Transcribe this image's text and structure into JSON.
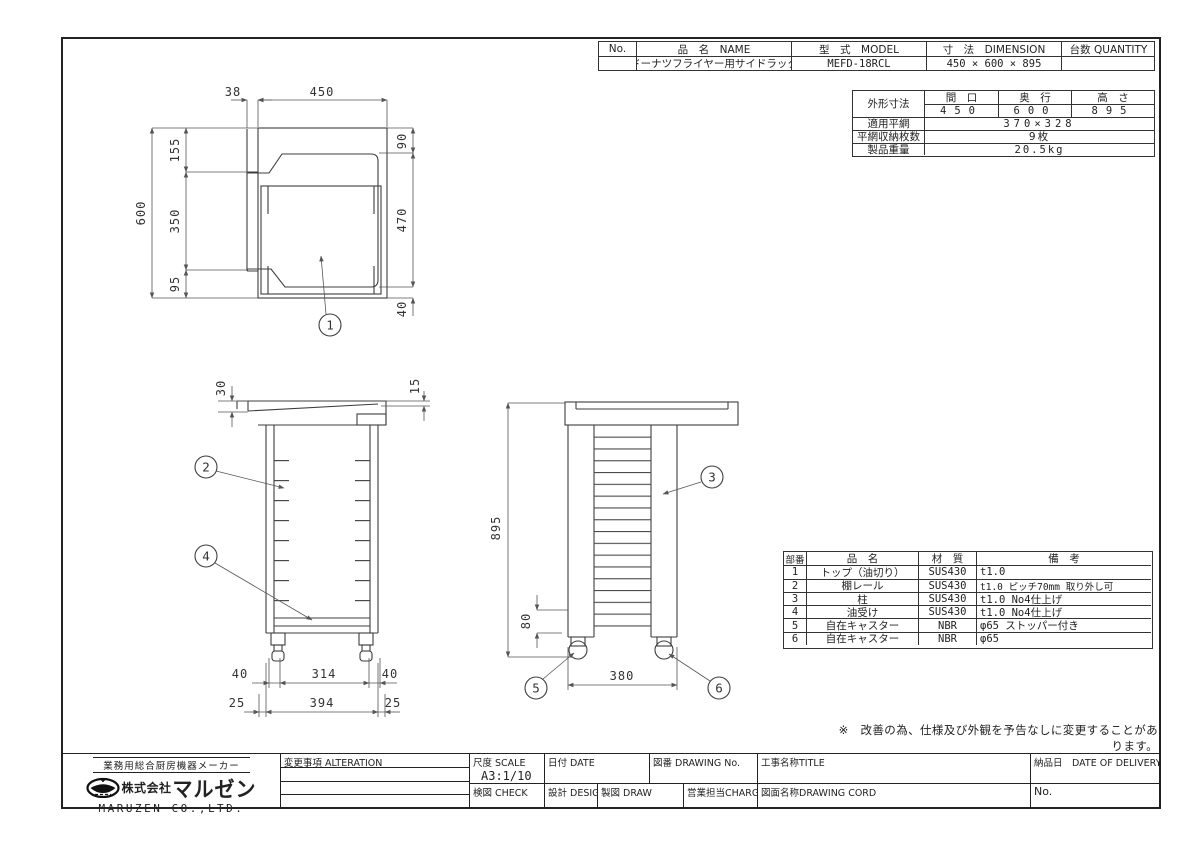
{
  "info_table": {
    "headers": {
      "no": "No.",
      "name": "品　名　NAME",
      "model": "型　式　MODEL",
      "dimension": "寸　法　DIMENSION",
      "quantity": "台数 QUANTITY"
    },
    "row": {
      "no": "",
      "name": "ドーナツフライヤー用サイドラック",
      "model": "MEFD-18RCL",
      "dimension": "450 × 600 × 895",
      "quantity": ""
    }
  },
  "spec_table": {
    "outer_dim_label": "外形寸法",
    "col_headers": [
      "間　口",
      "奥　行",
      "高　さ"
    ],
    "col_values": [
      "450",
      "600",
      "895"
    ],
    "mesh_label": "適用平網",
    "mesh_value": "370×328",
    "count_label": "平網収納枚数",
    "count_value": "9枚",
    "weight_label": "製品重量",
    "weight_value": "20.5kg"
  },
  "parts_table": {
    "headers": [
      "部番",
      "品　名",
      "材　質",
      "備　考"
    ],
    "rows": [
      [
        "1",
        "トップ（油切り）",
        "SUS430",
        "t1.0"
      ],
      [
        "2",
        "棚レール",
        "SUS430",
        "t1.0 ピッチ70mm 取り外し可"
      ],
      [
        "3",
        "柱",
        "SUS430",
        "t1.0 No4仕上げ"
      ],
      [
        "4",
        "油受け",
        "SUS430",
        "t1.0 No4仕上げ"
      ],
      [
        "5",
        "自在キャスター",
        "NBR",
        "φ65 ストッパー付き"
      ],
      [
        "6",
        "自在キャスター",
        "NBR",
        "φ65"
      ]
    ]
  },
  "note": "※　改善の為、仕様及び外観を予告なしに変更することがあります。",
  "dims": {
    "plan": {
      "offset": "38",
      "width": "450",
      "top": "155",
      "mid": "350",
      "bottom": "95",
      "total_depth": "600",
      "right_top": "90",
      "right_mid": "470",
      "right_bottom": "40"
    },
    "front": {
      "left_thk": "30",
      "right_thk": "15",
      "leg_left": "40",
      "leg_span": "314",
      "leg_right": "40",
      "edge_left": "25",
      "base_width": "394",
      "edge_right": "25"
    },
    "side": {
      "height": "895",
      "caster_h": "80",
      "depth_span": "380"
    }
  },
  "balloons": {
    "top": "1",
    "rail": "2",
    "post": "3",
    "drip": "4",
    "caster_front": "5",
    "caster_rear": "6"
  },
  "title_block": {
    "maker_tagline": "業務用総合厨房機器メーカー",
    "company_prefix": "株式会社",
    "company_brand": "マルゼン",
    "company_en": "MARUZEN CO.,LTD.",
    "alteration_label": "変更事項 ALTERATION",
    "scale_label": "尺度 SCALE",
    "scale_value": "A3:1/10",
    "date_label": "日付 DATE",
    "drawing_no_label": "図番 DRAWING No.",
    "title_label": "工事名称TITLE",
    "check_label": "検図 CHECK",
    "design_label": "設計 DESIGN",
    "draw_label": "製図 DRAW",
    "charge_label": "営業担当CHARGE",
    "drawing_cord_label": "図面名称DRAWING CORD",
    "delivery_label": "納品日　DATE OF DELIVERY",
    "no_label": "No."
  }
}
